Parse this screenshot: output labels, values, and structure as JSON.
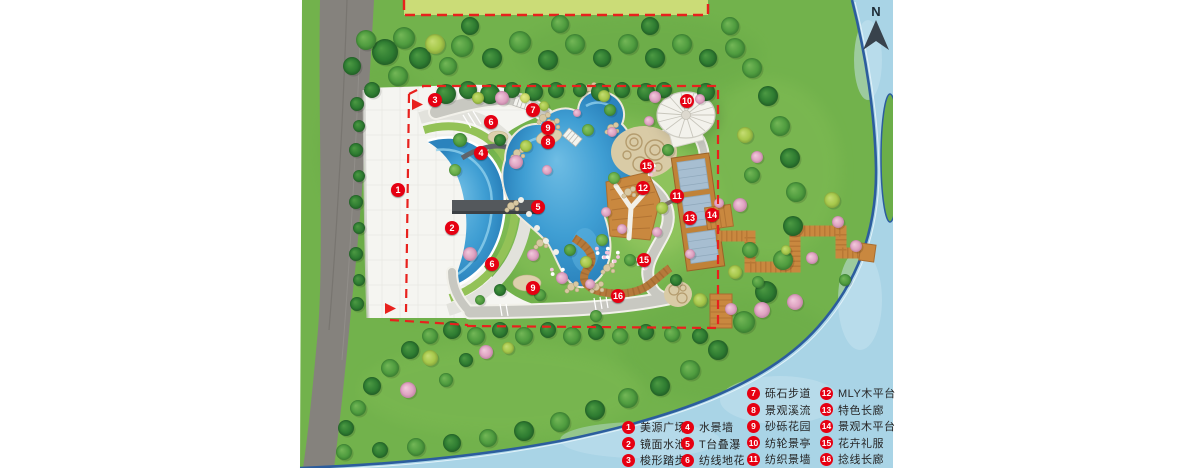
{
  "north_label": "N",
  "legend": {
    "columns": [
      {
        "items": [
          {
            "num": "1",
            "label": "美源广场"
          },
          {
            "num": "2",
            "label": "镜面水池"
          },
          {
            "num": "3",
            "label": "梭形踏步"
          }
        ]
      },
      {
        "items": [
          {
            "num": "4",
            "label": "水景墙"
          },
          {
            "num": "5",
            "label": "T台叠瀑"
          },
          {
            "num": "6",
            "label": "纺线地花"
          }
        ]
      },
      {
        "items": [
          {
            "num": "7",
            "label": "砾石步道"
          },
          {
            "num": "8",
            "label": "景观溪流"
          },
          {
            "num": "9",
            "label": "砂砾花园"
          },
          {
            "num": "10",
            "label": "纺轮景亭"
          },
          {
            "num": "11",
            "label": "纺织景墙"
          }
        ]
      },
      {
        "items": [
          {
            "num": "12",
            "label": "MLY木平台"
          },
          {
            "num": "13",
            "label": "特色长廊"
          },
          {
            "num": "14",
            "label": "景观木平台"
          },
          {
            "num": "15",
            "label": "花卉礼服"
          },
          {
            "num": "16",
            "label": "捻线长廊"
          }
        ]
      }
    ]
  },
  "plan_markers": [
    {
      "label": "1",
      "x": 398,
      "y": 190
    },
    {
      "label": "2",
      "x": 452,
      "y": 228
    },
    {
      "label": "3",
      "x": 435,
      "y": 100
    },
    {
      "label": "4",
      "x": 481,
      "y": 153
    },
    {
      "label": "5",
      "x": 538,
      "y": 207
    },
    {
      "label": "6",
      "x": 491,
      "y": 122
    },
    {
      "label": "6",
      "x": 492,
      "y": 264
    },
    {
      "label": "7",
      "x": 533,
      "y": 110
    },
    {
      "label": "8",
      "x": 548,
      "y": 142
    },
    {
      "label": "9",
      "x": 548,
      "y": 128
    },
    {
      "label": "9",
      "x": 533,
      "y": 288
    },
    {
      "label": "10",
      "x": 687,
      "y": 101
    },
    {
      "label": "11",
      "x": 677,
      "y": 196
    },
    {
      "label": "12",
      "x": 643,
      "y": 188
    },
    {
      "label": "13",
      "x": 690,
      "y": 218
    },
    {
      "label": "14",
      "x": 712,
      "y": 215
    },
    {
      "label": "15",
      "x": 647,
      "y": 166
    },
    {
      "label": "15",
      "x": 644,
      "y": 260
    },
    {
      "label": "16",
      "x": 618,
      "y": 296
    }
  ],
  "colors": {
    "marker_red": "#e60012",
    "boundary_red": "#e8211d",
    "river_blue": "#a9d4e6",
    "pool_blue": "#3f9ed3",
    "lawn_green": "#72b24c",
    "deck_orange": "#c9883f"
  }
}
